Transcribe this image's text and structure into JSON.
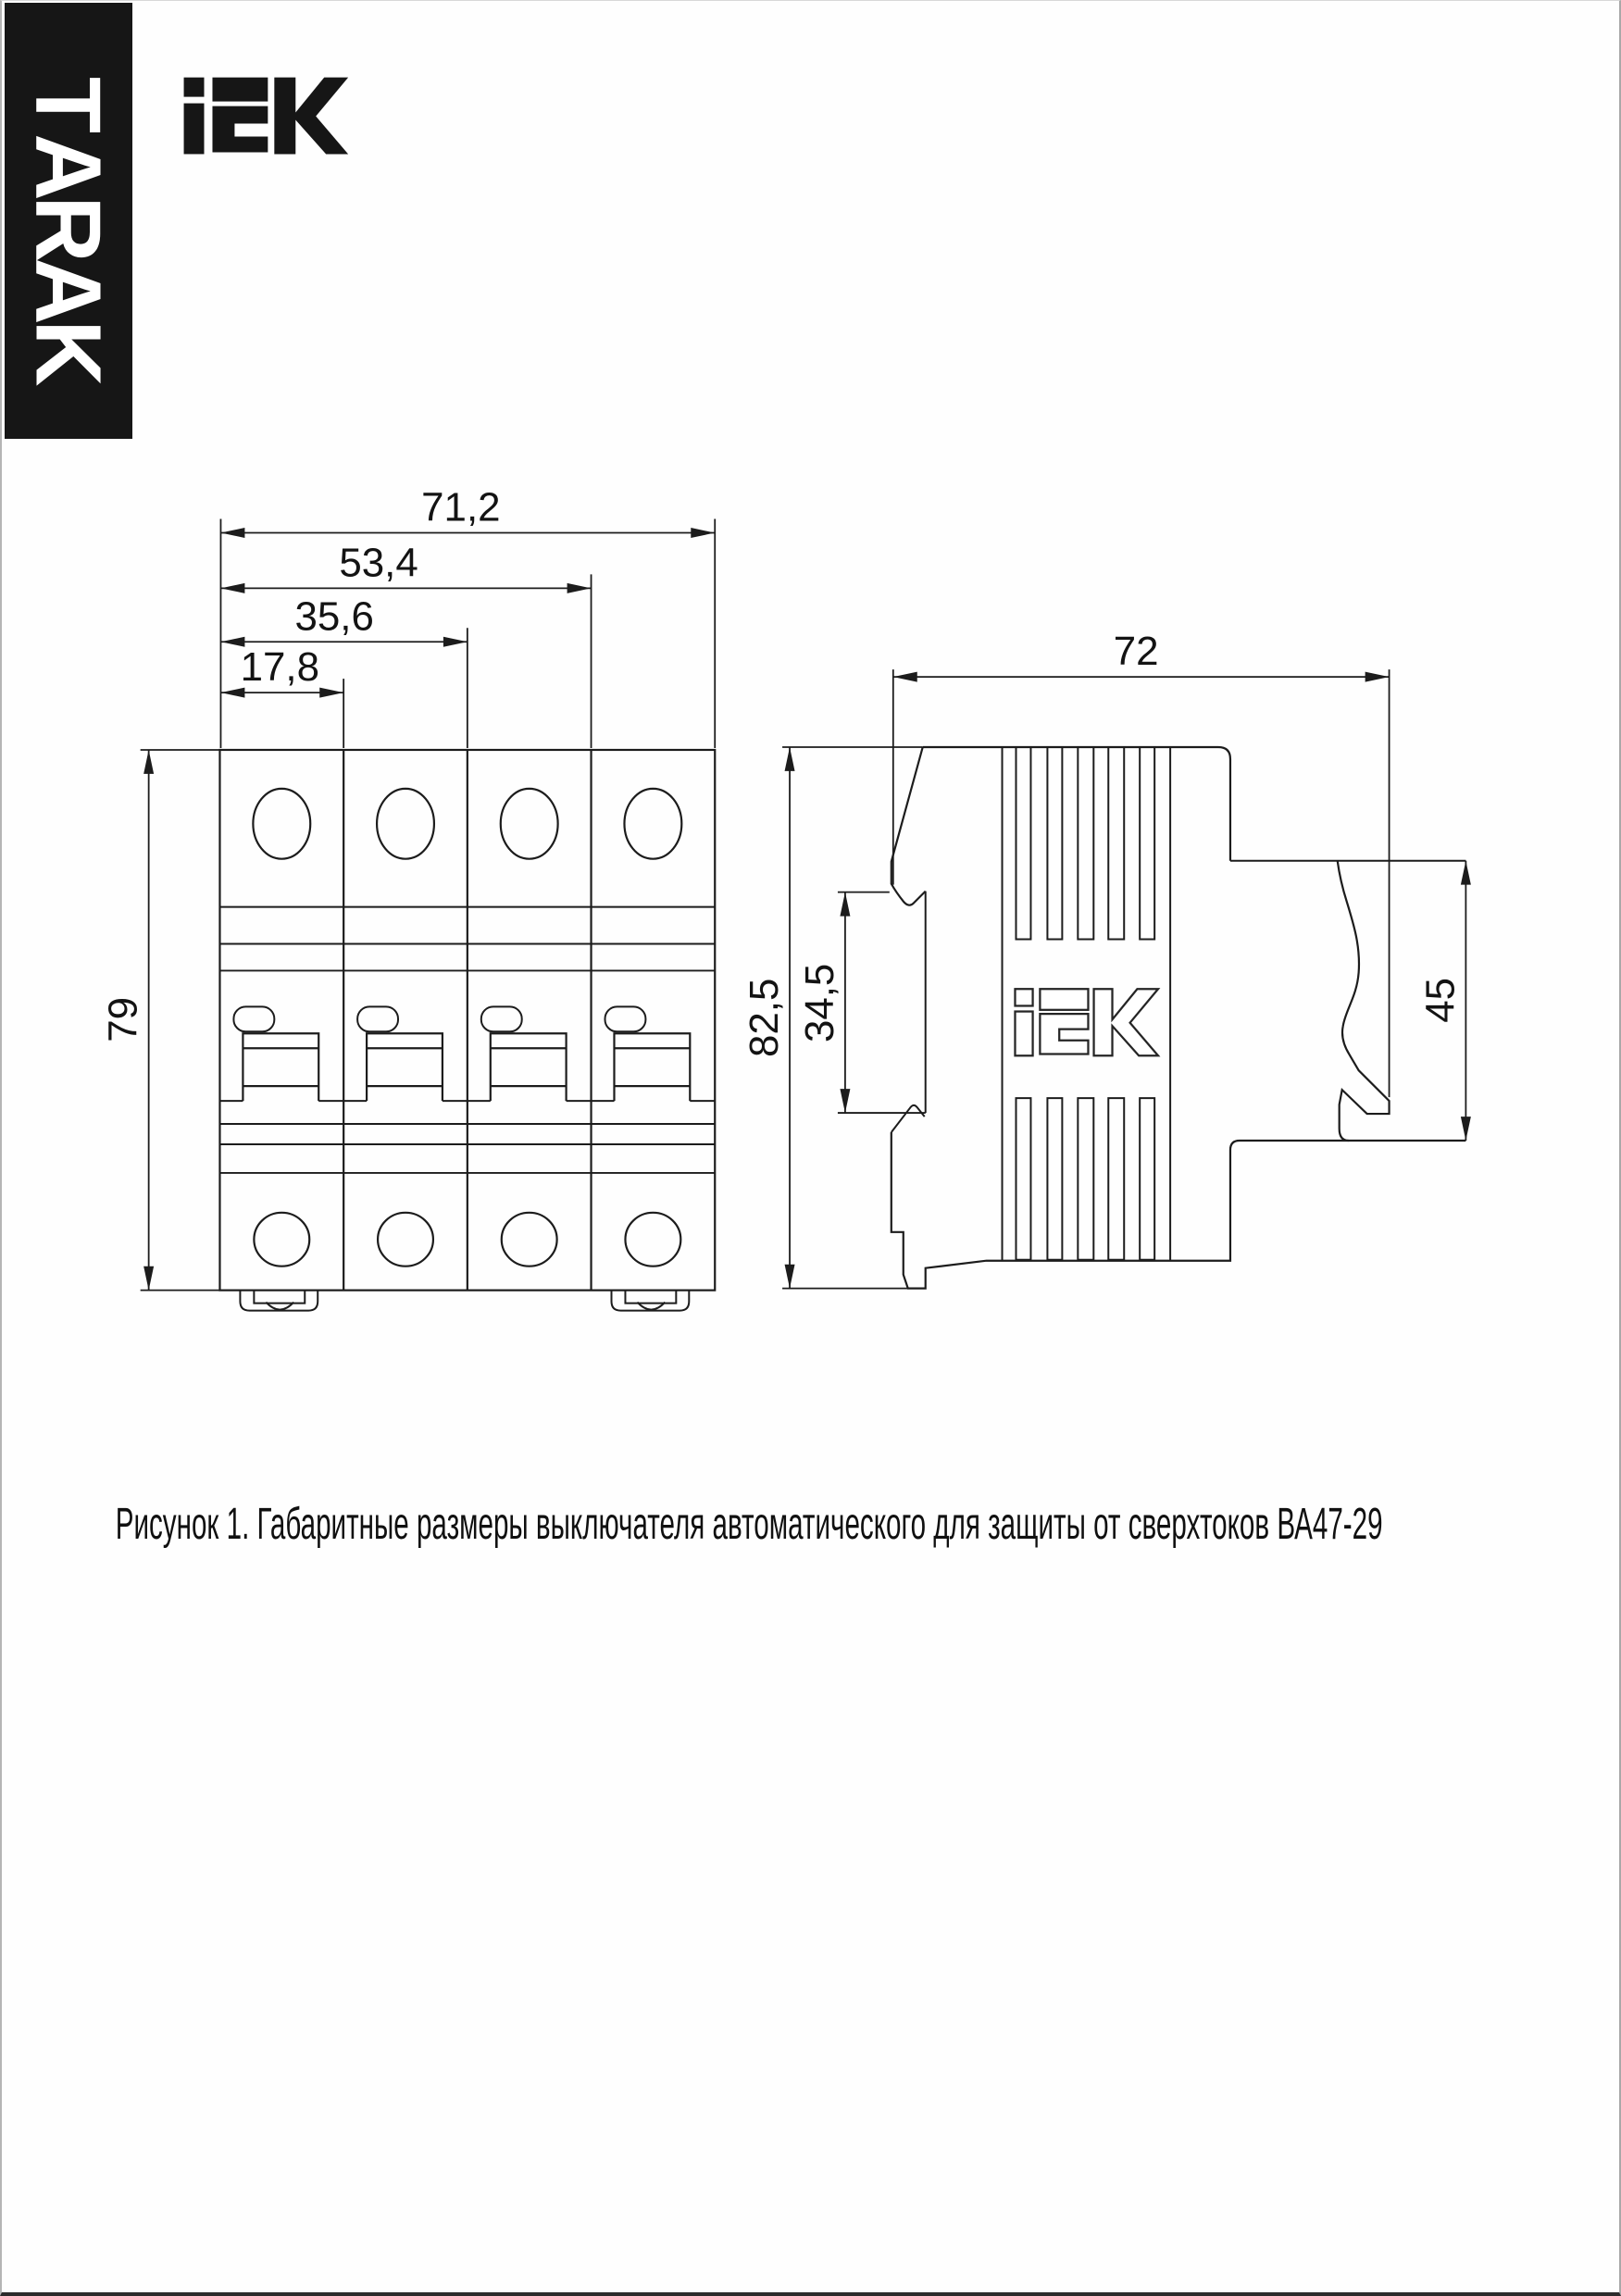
{
  "sidebar": {
    "brand": "KARAT",
    "bg_color": "#161616",
    "text_color": "#ffffff"
  },
  "header": {
    "logo": "IEK"
  },
  "figure": {
    "caption": "Рисунок 1. Габаритные размеры выключателя автоматического для защиты от сверхтоков ВА47-29",
    "front_view": {
      "title": "front view, 4-pole breaker",
      "dimensions": {
        "w_total": "71,2",
        "w_3": "53,4",
        "w_2": "35,6",
        "w_1": "17,8",
        "h": "79"
      }
    },
    "side_view": {
      "title": "side view",
      "embossed_logo": "IEK",
      "dimensions": {
        "depth": "72",
        "h_total": "82,5",
        "rail_channel": "34,5",
        "h_front": "45"
      }
    }
  },
  "colors": {
    "line": "#1c1c1c",
    "logo": "#161616"
  }
}
